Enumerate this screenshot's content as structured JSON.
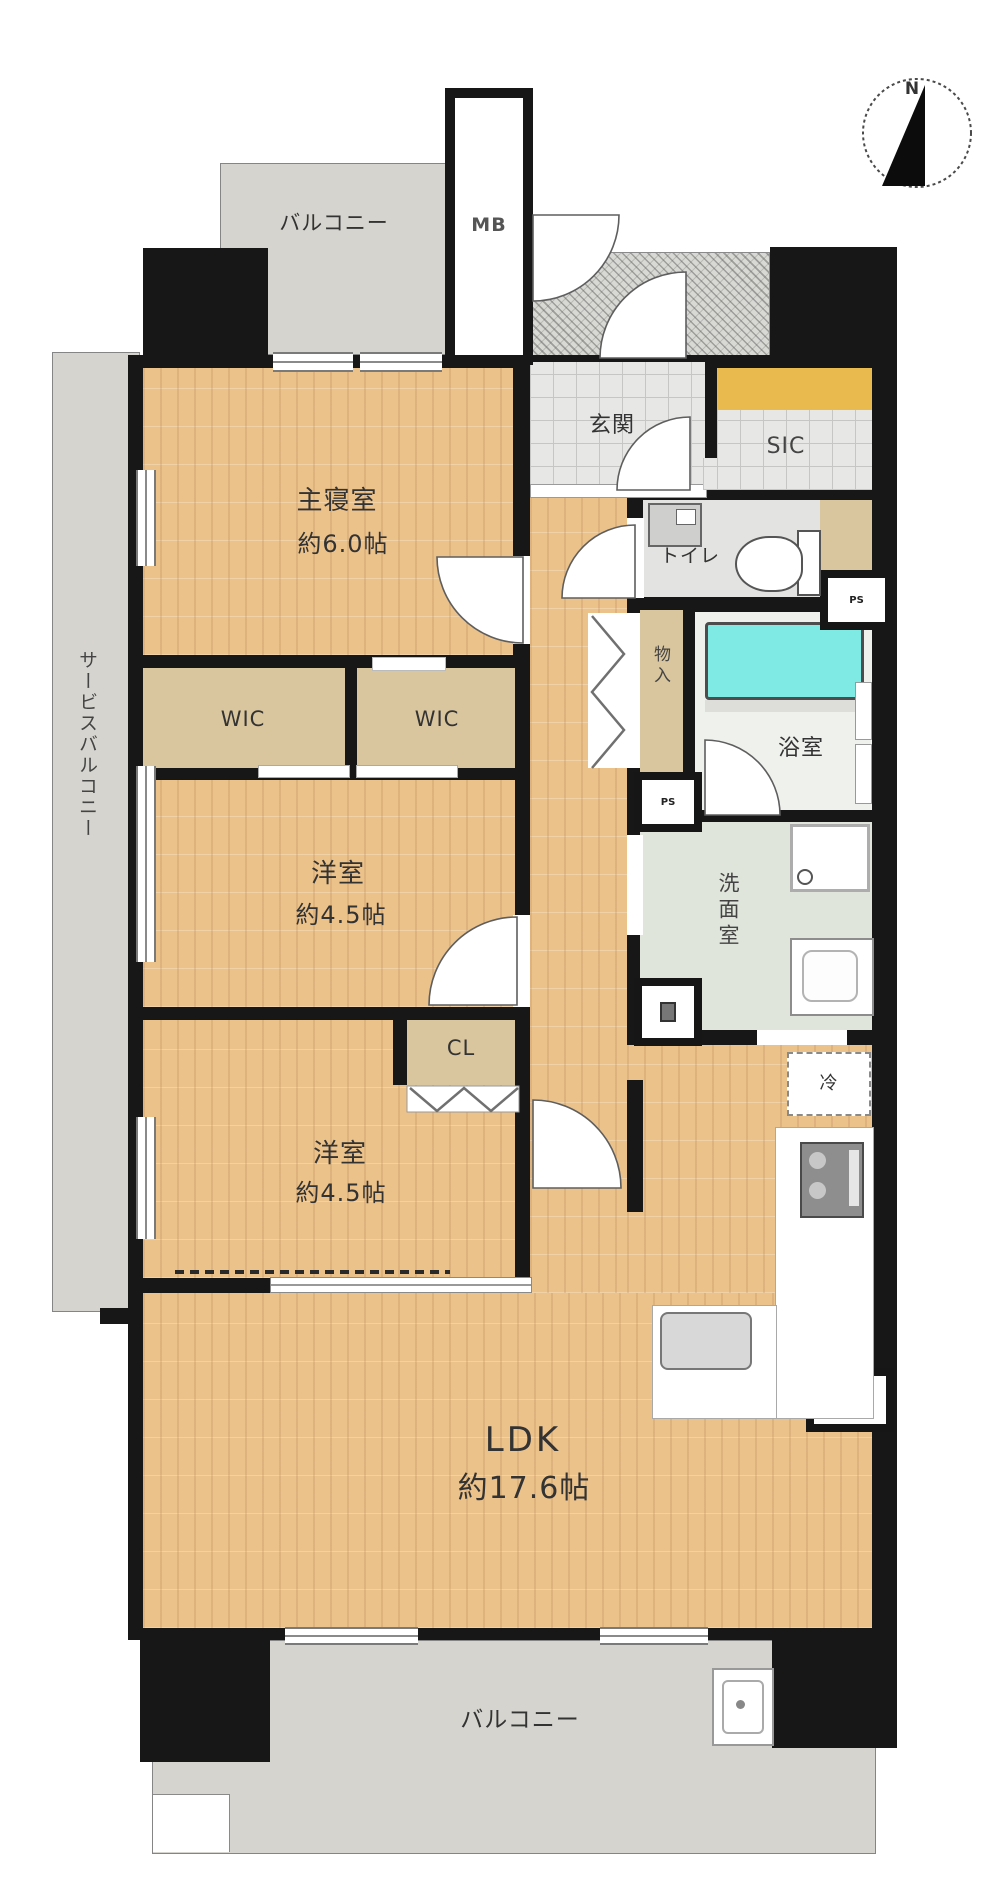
{
  "floor_plan": {
    "compass": {
      "north": "N"
    },
    "balcony_top": {
      "label": "バルコニー"
    },
    "balcony_bottom": {
      "label": "バルコニー"
    },
    "service_balcony": {
      "label": "サービスバルコニー"
    },
    "entrance": {
      "genkan": "玄関",
      "sic": "SIC"
    },
    "utility": {
      "mb": "MB",
      "ps": "PS",
      "fridge": "冷"
    },
    "rooms": {
      "master": {
        "name": "主寝室",
        "size": "約6.0帖"
      },
      "western1": {
        "name": "洋室",
        "size": "約4.5帖"
      },
      "western2": {
        "name": "洋室",
        "size": "約4.5帖"
      },
      "ldk": {
        "name": "LDK",
        "size": "約17.6帖"
      },
      "bathroom": {
        "name": "浴室"
      },
      "washroom": {
        "name": "洗面室"
      },
      "toilet": {
        "name": "トイレ"
      }
    },
    "storage": {
      "wic1": "WIC",
      "wic2": "WIC",
      "cl": "CL",
      "monoire": "物入"
    },
    "colors": {
      "wall_black": "#171717",
      "wood_floor": "#ecc28b",
      "closet_tan": "#d9c69e",
      "balcony_gray": "#d6d4ce",
      "tile_gray": "#e7e7e5",
      "bathtub_cyan": "#7fe9e3",
      "sic_shelf_orange": "#e9bb4e",
      "washroom_green": "#e0e5db"
    }
  }
}
